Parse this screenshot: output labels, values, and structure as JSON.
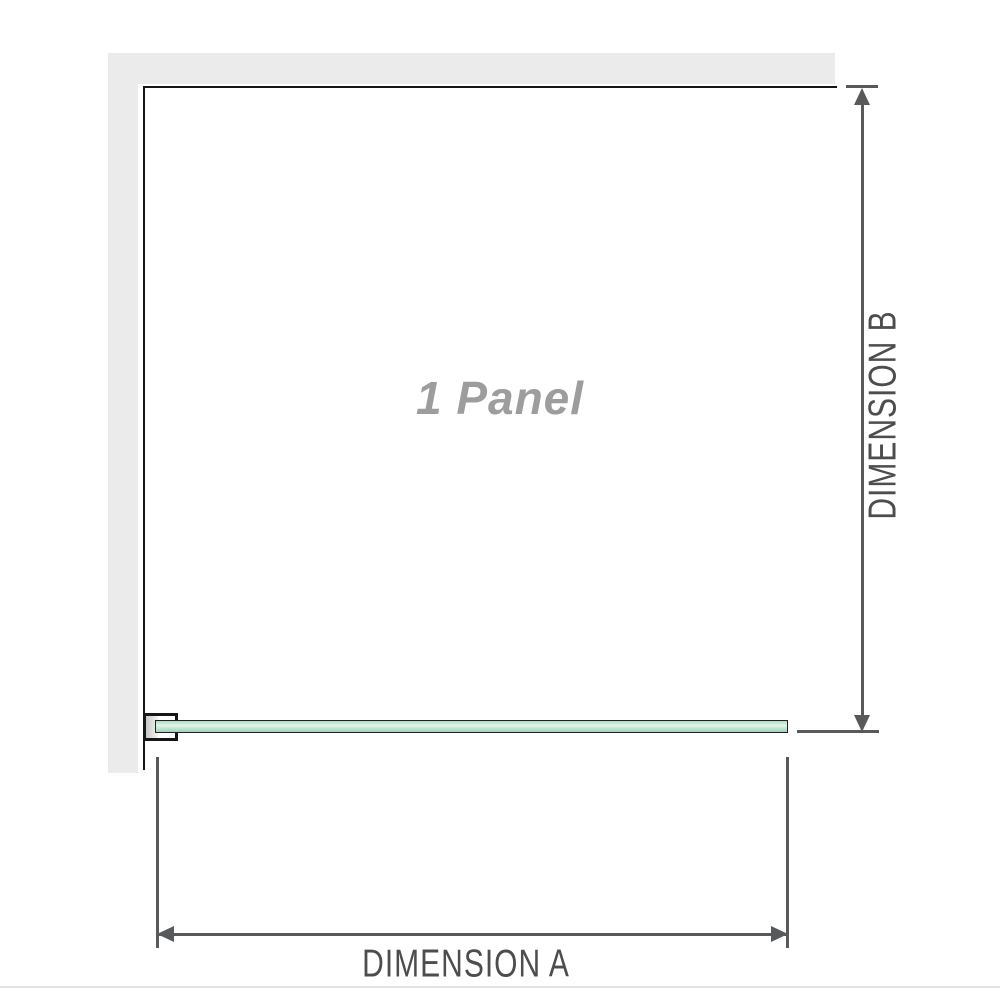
{
  "diagram": {
    "title_watermark": "1 Panel",
    "dimension_a": {
      "label": "DIMENSION A"
    },
    "dimension_b": {
      "label": "DIMENSION B"
    },
    "colors": {
      "wall_fill": "#ebebeb",
      "outline": "#161616",
      "dimension_lines": "#58595b",
      "dimension_text": "#4d4d4f",
      "watermark_text": "#9d9d9d",
      "glass_green": "#9cd2b4",
      "glass_highlight": "#e6f4ec"
    }
  }
}
